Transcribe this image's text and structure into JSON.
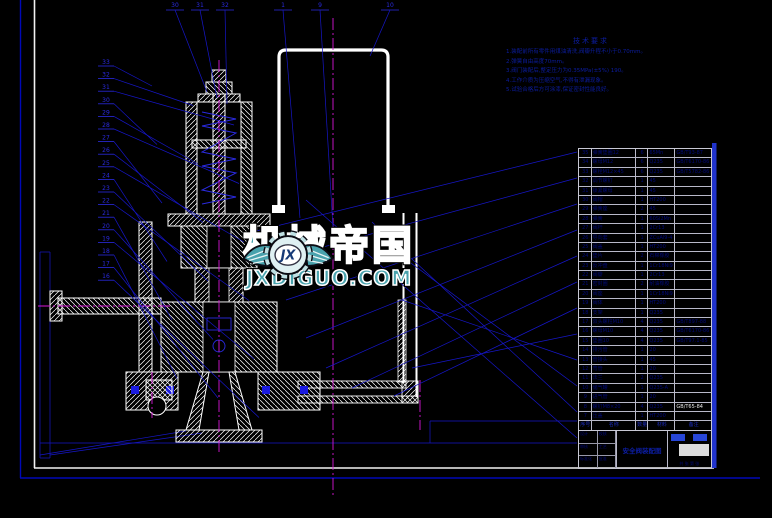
{
  "watermark": {
    "brand": "机械帝国",
    "domain": "JXDIGUO.COM",
    "emblem_text": "JX",
    "accent_color": "#49a2ad"
  },
  "tech_requirements": {
    "title": "技术要求",
    "items": [
      "1.装配前所有零件用煤油清洗,阀瓣升程不小于0.70mm。",
      "2.弹簧自由高度70mm。",
      "3.阀门装配后,整定压力为0.35MPa(±5%) 190。",
      "4.工作介质为压缩空气,不得有泄漏现象。",
      "5.试验合格后方可涂漆,保证密封性能良好。"
    ]
  },
  "balloons": {
    "top": [
      "30",
      "31",
      "32",
      "1",
      "9",
      "10"
    ],
    "left": [
      "33",
      "32",
      "31",
      "30",
      "29",
      "28",
      "27",
      "26",
      "25",
      "24",
      "23",
      "22",
      "21",
      "20",
      "19",
      "18",
      "17",
      "16"
    ]
  },
  "parts_table": {
    "headers": [
      "序号",
      "名称",
      "数量",
      "材料",
      "备注"
    ],
    "rows": [
      [
        "35",
        "弹簧垫圈12",
        "6",
        "65Mn",
        "GB/T93-87"
      ],
      [
        "34",
        "螺母M12",
        "6",
        "Q235",
        "GB/T6170-86"
      ],
      [
        "33",
        "螺栓M12×45",
        "6",
        "Q235",
        "GB/T5782-86"
      ],
      [
        "32",
        "调节螺钉",
        "1",
        "45",
        ""
      ],
      [
        "31",
        "锁紧螺母",
        "1",
        "45",
        ""
      ],
      [
        "30",
        "阀帽",
        "1",
        "HT200",
        ""
      ],
      [
        "29",
        "弹簧座",
        "2",
        "45",
        ""
      ],
      [
        "28",
        "弹簧",
        "1",
        "60Si2Mn",
        ""
      ],
      [
        "27",
        "阀杆",
        "1",
        "2Cr13",
        ""
      ],
      [
        "26",
        "导向套",
        "1",
        "ZCuAl9-4",
        ""
      ],
      [
        "25",
        "阀盖",
        "1",
        "HT200",
        ""
      ],
      [
        "24",
        "垫片",
        "2",
        "石棉橡胶",
        ""
      ],
      [
        "23",
        "反冲盘",
        "1",
        "1Cr18Ni9",
        ""
      ],
      [
        "22",
        "阀瓣",
        "1",
        "2Cr13",
        ""
      ],
      [
        "21",
        "密封圈",
        "2",
        "耐油橡胶",
        ""
      ],
      [
        "20",
        "阀座",
        "1",
        "1Cr18Ni9",
        ""
      ],
      [
        "19",
        "阀体",
        "1",
        "HT200",
        ""
      ],
      [
        "18",
        "支架",
        "1",
        "Q235",
        ""
      ],
      [
        "17",
        "双头螺柱M10",
        "4",
        "Q235",
        "GB/T897-88"
      ],
      [
        "16",
        "螺母M10",
        "4",
        "Q235",
        "GB/T6170-86"
      ],
      [
        "15",
        "垫圈10",
        "4",
        "Q235",
        "GB/T97.1-85"
      ],
      [
        "14",
        "排污管",
        "1",
        "20",
        ""
      ],
      [
        "13",
        "管接头",
        "1",
        "45",
        ""
      ],
      [
        "12",
        "弯管",
        "1",
        "20",
        ""
      ],
      [
        "11",
        "法兰",
        "2",
        "Q235",
        ""
      ],
      [
        "10",
        "储气罐",
        "1",
        "Q235-A",
        ""
      ],
      [
        "9",
        "进气管",
        "1",
        "20",
        ""
      ],
      [
        "8",
        "螺钉M8×20",
        "4",
        "Q235",
        "GB/T65-84"
      ],
      [
        "7",
        "压盖",
        "1",
        "HT200",
        ""
      ]
    ],
    "highlight_note_no": "8"
  },
  "title_block": {
    "title": "安全阀装配图",
    "labels": [
      "设计",
      "",
      "校核",
      "",
      "审核",
      "",
      "工艺",
      "",
      "标准化",
      "",
      "批准",
      ""
    ],
    "sheet": "共 张 第 张"
  },
  "colors": {
    "background": "#000000",
    "frame_white": "#f2f2f2",
    "frame_blue": "#0008b8",
    "highlight_bar": "#2033cc",
    "leader_blue": "#1616c8",
    "centerline_magenta": "#d718d7",
    "balloon_blue": "#2a2ae0",
    "table_text": "#000a7a"
  }
}
